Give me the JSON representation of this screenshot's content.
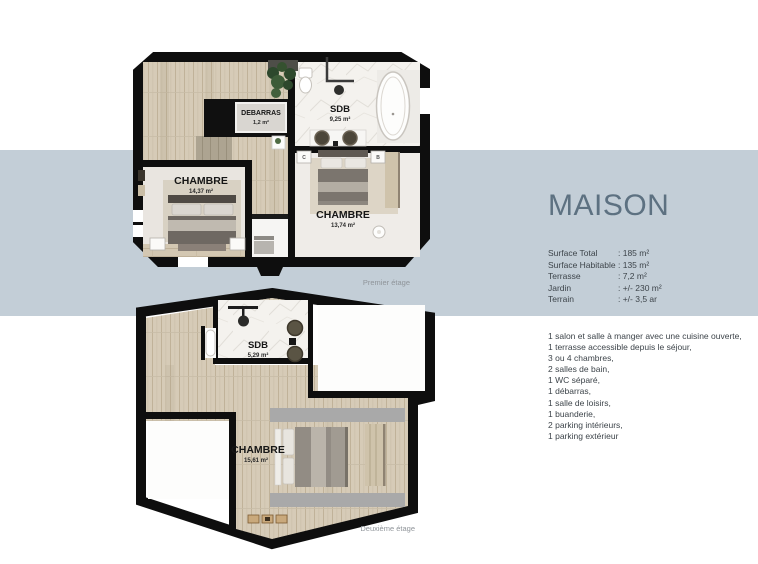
{
  "title": "MAISON",
  "specs": [
    {
      "label": "Surface Total",
      "value": ": 185 m²"
    },
    {
      "label": "Surface Habitable",
      "value": ": 135 m²"
    },
    {
      "label": "Terrasse",
      "value": ": 7,2 m²"
    },
    {
      "label": "Jardin",
      "value": ": +/- 230 m²"
    },
    {
      "label": "Terrain",
      "value": ": +/- 3,5 ar"
    }
  ],
  "features": [
    "1 salon et salle à manger avec une cuisine ouverte,",
    "1 terrasse accessible depuis le séjour,",
    "3 ou 4 chambres,",
    "2 salles de bain,",
    "1 WC séparé,",
    "1 débarras,",
    "1 salle de loisirs,",
    "1 buanderie,",
    "2 parking intérieurs,",
    "1 parking extérieur"
  ],
  "floor1": {
    "caption": "Premier étage",
    "rooms": {
      "debarras": {
        "name": "DEBARRAS",
        "area": "1,2 m²"
      },
      "sdb": {
        "name": "SDB",
        "area": "9,25 m²"
      },
      "chambre1": {
        "name": "CHAMBRE",
        "area": "14,37 m²"
      },
      "chambre2": {
        "name": "CHAMBRE",
        "area": "13,74 m²"
      }
    },
    "tags": {
      "left": "C",
      "right": "B"
    }
  },
  "floor2": {
    "caption": "Deuxième étage",
    "rooms": {
      "sdb": {
        "name": "SDB",
        "area": "5,29 m²"
      },
      "chambre": {
        "name": "CHAMBRE",
        "area": "15,61 m²"
      }
    }
  },
  "colors": {
    "band": "#c3ced7",
    "title": "#5d7181",
    "body_text": "#3d444a",
    "caption": "#8f9499",
    "wall": "#0e0e0e",
    "wood": "#d6cbb7",
    "marble": "#f4f2ee"
  }
}
